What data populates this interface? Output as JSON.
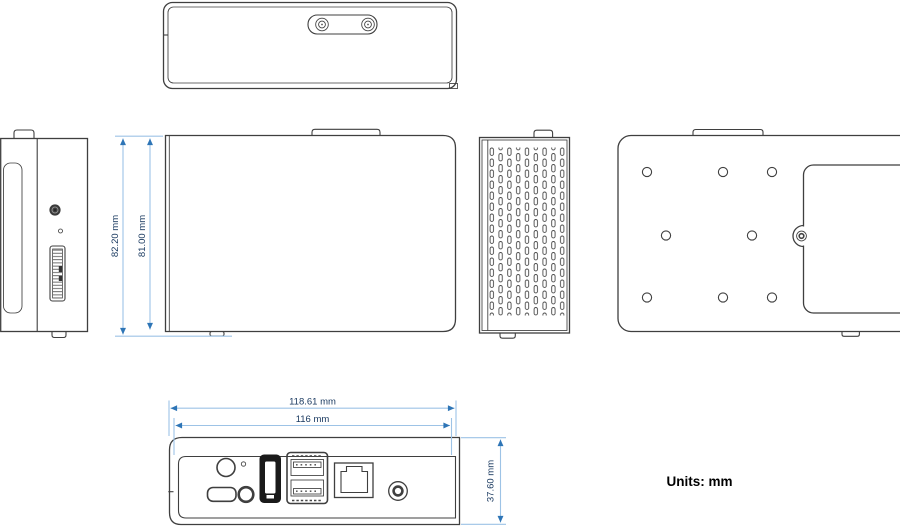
{
  "units_label": "Units: mm",
  "dims": {
    "height_outer": "82.20 mm",
    "height_body": "81.00 mm",
    "width_outer": "118.61 mm",
    "width_body": "116 mm",
    "depth": "37.60 mm"
  },
  "colors": {
    "outline": "#3f3f3f",
    "dim_line": "#9dc3e6",
    "dim_arrow": "#2e75b6",
    "dim_text": "#17375e",
    "port_fill": "#1a1a1a",
    "background": "#ffffff"
  },
  "views": [
    "top-view",
    "left-side-view",
    "front-view",
    "vented-side-view",
    "rear-view",
    "io-panel-view"
  ],
  "ports": [
    "power-button",
    "status-led",
    "micro-usb-port",
    "audio-jack",
    "hdmi-port",
    "dual-usb-port",
    "ethernet-port",
    "dc-jack",
    "edge-connector"
  ]
}
